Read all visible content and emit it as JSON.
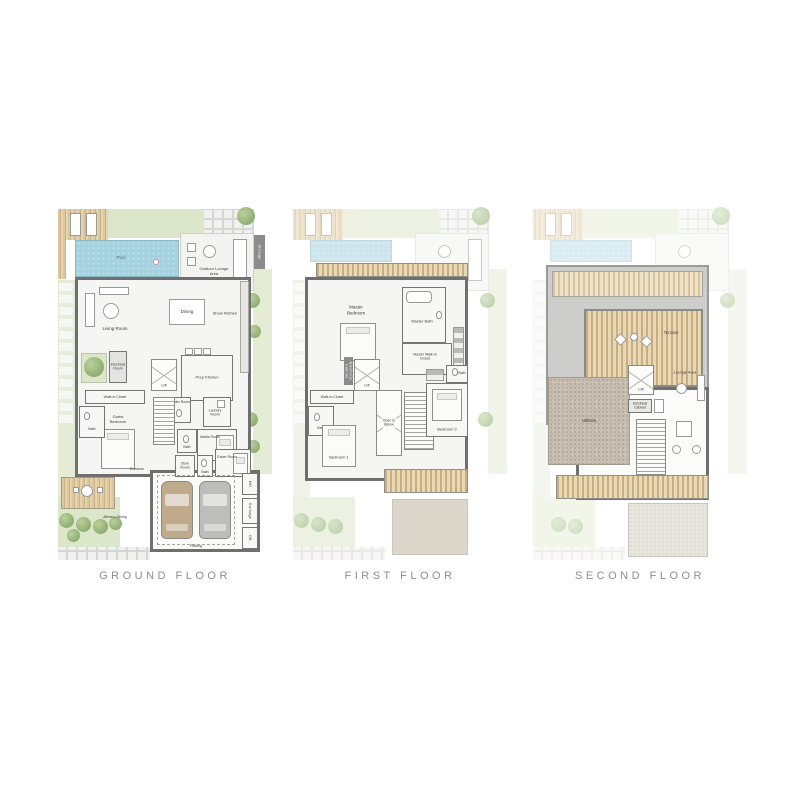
{
  "titles": {
    "ground": "GROUND FLOOR",
    "first": "FIRST FLOOR",
    "second": "SECOND FLOOR"
  },
  "colors": {
    "pool_blue": "#a5d2df",
    "deck_wood": "#d9c49c",
    "lawn_green": "#dce6cb",
    "wall_gray": "#6f6f6f",
    "utility_gravel": "#c6bcb0",
    "title_text": "#8e8e8e"
  },
  "plans": {
    "ground": {
      "rooms": {
        "pool": "Pool",
        "outdoor_lounge": "Outdoor Lounge Area",
        "storage": "Storage",
        "living": "Living Room",
        "dining": "Dining",
        "show_kitchen": "Show Kitchen",
        "prep_kitchen": "Prep Kitchen",
        "lift": "Lift",
        "electrical": "Electrical Room",
        "powder": "Powder Room",
        "laundry": "Laundry Room",
        "walkin": "Walk-In Closet",
        "guest_bath": "Bath",
        "guest_bedroom": "Guest Bedroom",
        "maids": "Maids Room",
        "maids_bath": "Bath",
        "store": "Store Room",
        "driver": "Driver Room",
        "driver_bath": "Bath",
        "entrance": "Entrance",
        "parking": "Parking",
        "alfresco": "Alfresco Dining",
        "md": "MD",
        "garbage": "Garbage",
        "db": "DB"
      }
    },
    "first": {
      "rooms": {
        "canopy": "Canopy",
        "master_bedroom": "Master Bedroom",
        "master_bath": "Master Bath",
        "master_wic": "Master Walk-In Closet",
        "lift": "Lift",
        "electrical": "Electrical Cabinet",
        "walkin": "Walk-In Closet",
        "bath1": "Bath",
        "bedroom1": "Bedroom 1",
        "open_below": "Open to Below",
        "bedroom2": "Bedroom 2",
        "bath2": "Bath"
      }
    },
    "second": {
      "rooms": {
        "terrace": "Terrace",
        "lift": "Lift",
        "lounge": "Lounge Area",
        "electrical": "Electrical Cabinet",
        "utilities": "Utilities"
      }
    }
  }
}
